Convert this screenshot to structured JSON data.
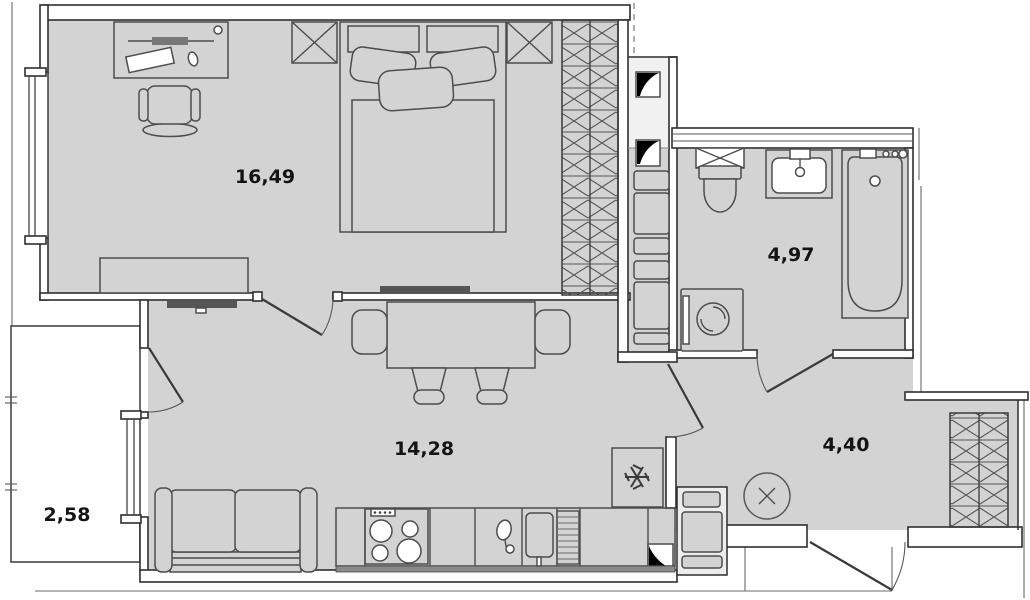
{
  "plan": {
    "type": "apartment-floor-plan",
    "units": "square-meters-decimal-comma",
    "rooms": {
      "bedroom": {
        "name": "bedroom",
        "area_label": "16,49"
      },
      "bathroom": {
        "name": "bathroom",
        "area_label": "4,97"
      },
      "living_kitchen": {
        "name": "living-kitchen",
        "area_label": "14,28"
      },
      "hallway": {
        "name": "hallway",
        "area_label": "4,40"
      },
      "balcony": {
        "name": "balcony",
        "area_label": "2,58"
      }
    },
    "fixtures": {
      "bedroom": [
        "desk",
        "office-chair",
        "nightstand",
        "double-bed",
        "nightstand",
        "wardrobe",
        "tv",
        "low-cabinet",
        "window"
      ],
      "bathroom": [
        "vent-grille",
        "toilet",
        "washbasin",
        "bathtub",
        "washing-machine"
      ],
      "living_kitchen": [
        "tv",
        "dining-table",
        "armchair",
        "armchair",
        "chair",
        "chair",
        "sofa",
        "refrigerator",
        "stove",
        "faucet",
        "kitchen-sink",
        "dish-rack",
        "balcony-door",
        "window"
      ],
      "hallway": [
        "wardrobe",
        "ceiling-fan",
        "entrance-door"
      ],
      "service": [
        "vent-shaft",
        "vent-shaft",
        "vent-shaft",
        "riser-ducts",
        "riser-ducts"
      ]
    },
    "colors": {
      "floor": "#d3d3d3",
      "wall_fill": "#ffffff",
      "wall_line": "#2f2f2f",
      "furniture_line": "#4d4d4d",
      "shaft_black": "#000000",
      "label_text": "#141414"
    }
  }
}
